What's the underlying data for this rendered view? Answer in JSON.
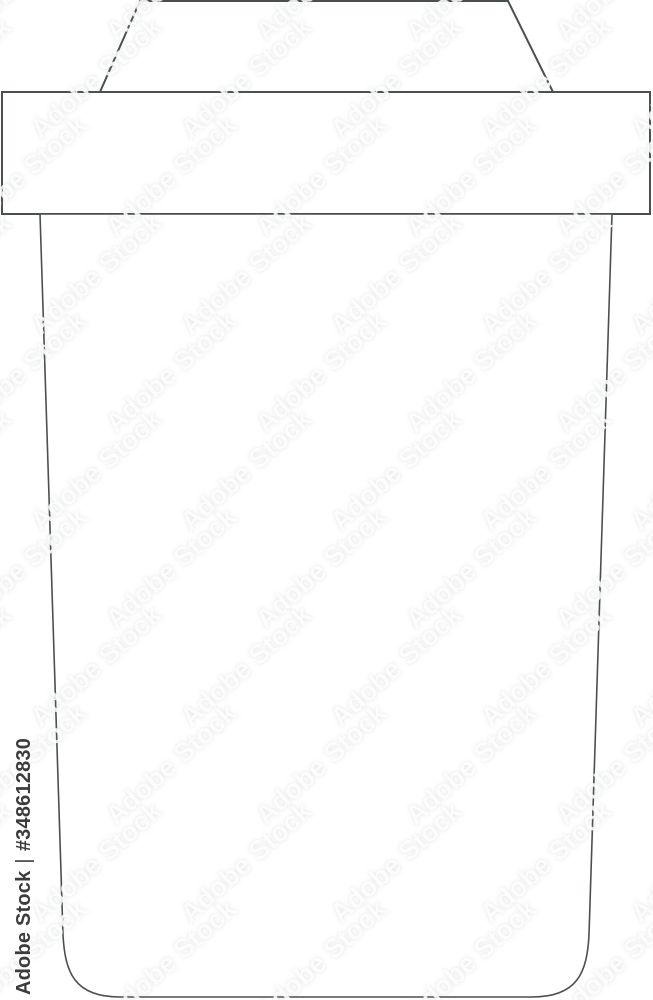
{
  "illustration": {
    "name": "paper-coffee-cup-line-art",
    "parts": [
      "lid-top",
      "lid-band",
      "cup-body",
      "sleeve-band-lines",
      "blank-logo-circle"
    ]
  },
  "watermark": {
    "tile_text": "Adobe Stock",
    "attribution_brand": "Adobe Stock",
    "attribution_separator": "|",
    "attribution_id": "#348612830"
  },
  "colors": {
    "background": "#ffffff",
    "outline": "#4a4f4f",
    "attribution_text": "#3c3c3c",
    "watermark_shadow": "#949999",
    "watermark_opacity": 0.22
  }
}
